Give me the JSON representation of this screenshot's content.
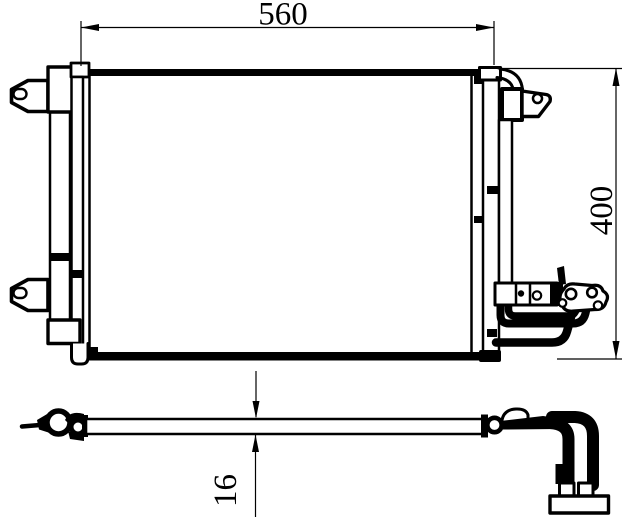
{
  "drawing": {
    "title": "condenser-technical-drawing",
    "dimensions": {
      "width_label": "560",
      "height_label": "400",
      "thickness_label": "16"
    },
    "colors": {
      "line": "#000000",
      "background": "#ffffff"
    }
  }
}
